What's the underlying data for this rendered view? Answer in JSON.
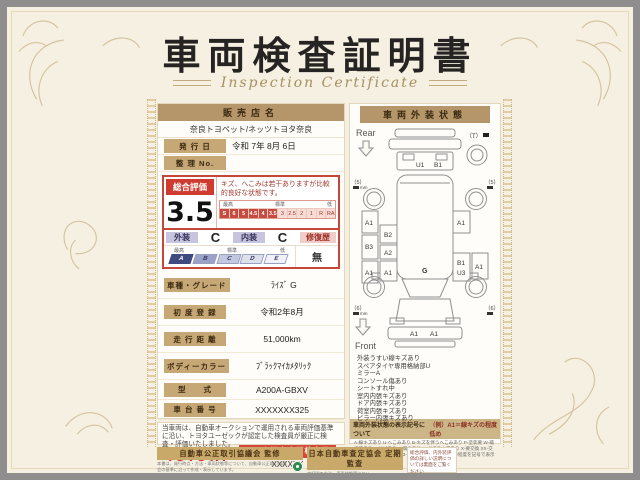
{
  "title": {
    "main": "車両検査証明書",
    "sub": "Inspection Certificate"
  },
  "dealer": {
    "header": "販売店名",
    "name": "奈良トヨペット/ネッツトヨタ奈良",
    "issue_label": "発 行 日",
    "issue_value": "令和 7年 8月 6日",
    "ref_label": "整 理 No.",
    "ref_value": ""
  },
  "rating": {
    "label": "総合評価",
    "score": "3.5",
    "comment": "キズ、へこみは若干ありますが比較的良好な状態です。",
    "scale_high": "最高",
    "scale_std": "標準",
    "scale_low": "低",
    "cells": [
      "S",
      "6",
      "5",
      "4.5",
      "4",
      "3.5",
      "3",
      "2.5",
      "2",
      "1",
      "R",
      "RA"
    ]
  },
  "grades": {
    "exterior_label": "外装",
    "exterior_value": "C",
    "interior_label": "内装",
    "interior_value": "C",
    "repair_label": "修復歴",
    "repair_value": "無",
    "letter_high": "最高",
    "letter_std": "標準",
    "letter_low": "低",
    "letters": [
      "A",
      "B",
      "C",
      "D",
      "E"
    ]
  },
  "fields": [
    {
      "label": "車種・グレード",
      "value": "ﾗｲｽﾞ G"
    },
    {
      "label": "初 度 登 録",
      "value": "令和2年8月"
    },
    {
      "label": "走 行 距 離",
      "value": "51,000km"
    },
    {
      "label": "ボディーカラー",
      "value": "ﾌﾞﾗｯｸﾏｲｶﾒﾀﾘｯｸ"
    },
    {
      "label": "型　　式",
      "value": "A200A-GBXV"
    },
    {
      "label": "車 台 番 号",
      "value": "XXXXXXX325"
    },
    {
      "label": "エ ン ジ ン",
      "value": "ｶﾞｿﾘﾝ"
    }
  ],
  "inspector": {
    "logo": "TOYOTA",
    "badge": "トヨタ認定車両検査員",
    "number": "XXXXXX"
  },
  "note": "当車両は、自動車オークションで運用される車両評価基準に沿い、トヨタユーゼックが認定した検査員が厳正に検査・評価いたしました。",
  "exterior": {
    "header": "車両外装状態",
    "rear": "Rear",
    "front": "Front",
    "car": {
      "tailgate": [
        "U1",
        "B1"
      ],
      "left_outer": [
        "A1",
        "B3",
        "A1"
      ],
      "left_inner": [
        "B2",
        "A2",
        "A1"
      ],
      "right_inner": [
        "A1",
        "B1",
        "U3"
      ],
      "right_outer": [
        "A1"
      ],
      "hood": "G",
      "bumper": [
        "A1",
        "A1"
      ],
      "spare": "（T）",
      "tread_rl": "（5）",
      "tread_rr": "（5）",
      "tread_fl": "（6）",
      "tread_fr": "（6）",
      "unit": "mm"
    },
    "conditions": [
      "外装うすい線キズあり",
      "スペアタイヤ専用格納部U",
      "ミラーA",
      "コンソール傷あり",
      "シートすれ中",
      "室内内張キズあり",
      "ドア内張キズあり",
      "荷室内張キズあり",
      "ピラー内張キズあり"
    ],
    "symbols": {
      "header": "車両外装状態の表示記号について",
      "example": "（例）A1＝線キズの程度低め",
      "legend": "A-線キズあり U-へこみあり B-キズを伴うへこみあり P-塗装要 W-補修跡あり S-サビあり C-腐食あり G-ガラスキズあり X-要交換 XX-交換済 1-小程度 2-中程度 3-大程度 ※キズや補修等の程度を記号で表示しています。"
    }
  },
  "footer": {
    "fair_title": "自動車公正取引協議会 監修",
    "fair_text": "本書は、発行時点・方法・車両状態等について、自動車公正取引協議会の基準に沿って作成・表示しています。",
    "jaai_title": "日本自動車査定協会 定期監査",
    "jaai_text": "本証明の方法・車両状態等について、日本自動車査定協会による定期監査を実施しています。",
    "jaai_logo": "JAAI",
    "back_note": "総合評価、内外装評価の詳しい説明については裏面をご覧ください"
  }
}
